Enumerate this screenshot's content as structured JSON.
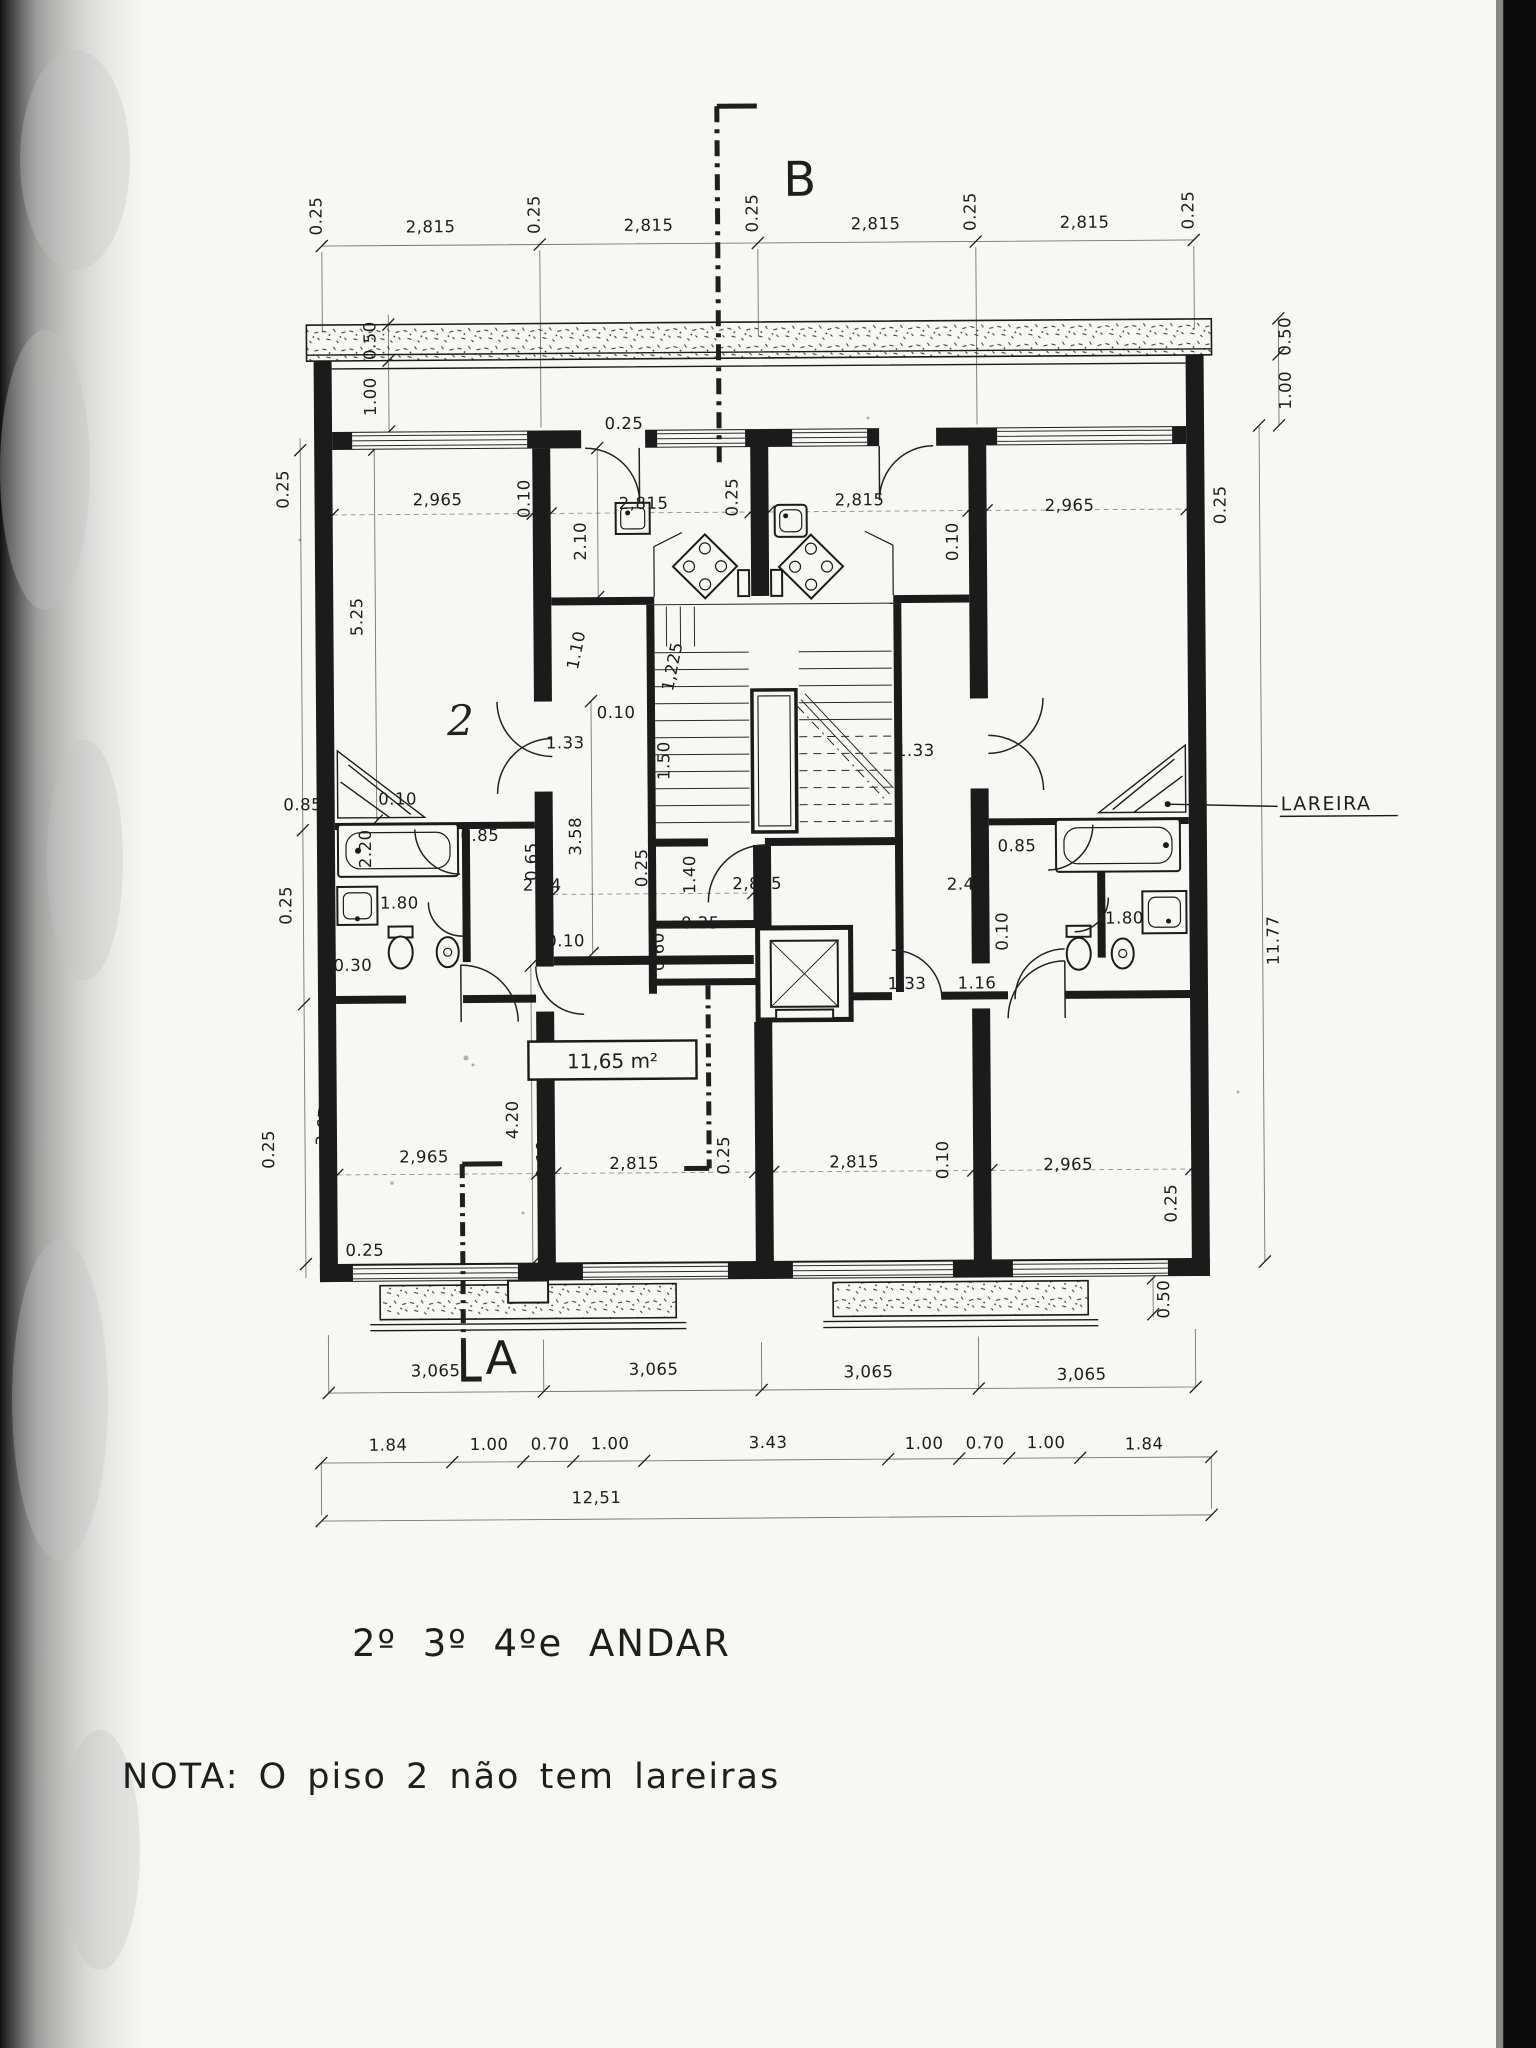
{
  "title": {
    "floor_label": "2º 3º 4ºe ANDAR"
  },
  "note": {
    "text": "NOTA: O  piso 2  não  tem  lareiras"
  },
  "annotations": {
    "lareira": "LAREIRA",
    "area_label": "11,65 m²",
    "section_b": "B",
    "section_a": "A",
    "hand_mark": "2"
  },
  "colors": {
    "ink": "#1b1b1b",
    "paper": "#f7f7f4",
    "scan_edge": "#0b0b0b"
  },
  "dimensions": [
    {
      "t": "0.25",
      "x": 326,
      "y": 213,
      "r": -90
    },
    {
      "t": "2,815",
      "x": 435,
      "y": 230
    },
    {
      "t": "0.25",
      "x": 544,
      "y": 213,
      "r": -90
    },
    {
      "t": "2,815",
      "x": 653,
      "y": 230
    },
    {
      "t": "0.25",
      "x": 762,
      "y": 213,
      "r": -90
    },
    {
      "t": "2,815",
      "x": 880,
      "y": 230
    },
    {
      "t": "0.25",
      "x": 980,
      "y": 213,
      "r": -90
    },
    {
      "t": "2,815",
      "x": 1089,
      "y": 230
    },
    {
      "t": "0.25",
      "x": 1198,
      "y": 213,
      "r": -90
    },
    {
      "t": "0.25",
      "x": 291,
      "y": 486,
      "r": -90
    },
    {
      "t": "0.50",
      "x": 379,
      "y": 338,
      "r": -90
    },
    {
      "t": "1.00",
      "x": 379,
      "y": 394,
      "r": -90
    },
    {
      "t": "5.25",
      "x": 364,
      "y": 614,
      "r": -90
    },
    {
      "t": "0.10",
      "x": 398,
      "y": 802
    },
    {
      "t": "2.20",
      "x": 371,
      "y": 846,
      "r": -90
    },
    {
      "t": "0.85",
      "x": 303,
      "y": 807
    },
    {
      "t": "1.80",
      "x": 399,
      "y": 906
    },
    {
      "t": "0.30",
      "x": 352,
      "y": 968
    },
    {
      "t": "0.25",
      "x": 291,
      "y": 902,
      "r": -90
    },
    {
      "t": "0.25",
      "x": 272,
      "y": 1146,
      "r": -90
    },
    {
      "t": "3.67",
      "x": 327,
      "y": 1124,
      "r": -85
    },
    {
      "t": "0.25",
      "x": 362,
      "y": 1253
    },
    {
      "t": "2,965",
      "x": 440,
      "y": 503
    },
    {
      "t": "2,815",
      "x": 646,
      "y": 508
    },
    {
      "t": "2,815",
      "x": 862,
      "y": 506
    },
    {
      "t": "2,965",
      "x": 1072,
      "y": 513
    },
    {
      "t": "0.10",
      "x": 532,
      "y": 497,
      "r": -90
    },
    {
      "t": "0.10",
      "x": 960,
      "y": 543,
      "r": -90
    },
    {
      "t": "2.10",
      "x": 588,
      "y": 540,
      "r": -90
    },
    {
      "t": "0.25",
      "x": 627,
      "y": 428
    },
    {
      "t": "0.25",
      "x": 740,
      "y": 497,
      "r": -90
    },
    {
      "t": "1.10",
      "x": 583,
      "y": 650,
      "r": -78
    },
    {
      "t": "1,225",
      "x": 679,
      "y": 667,
      "r": -78
    },
    {
      "t": "0.10",
      "x": 617,
      "y": 717
    },
    {
      "t": "1.33",
      "x": 566,
      "y": 747
    },
    {
      "t": "1.50",
      "x": 670,
      "y": 760,
      "r": -90
    },
    {
      "t": "1.33",
      "x": 916,
      "y": 757
    },
    {
      "t": "3.58",
      "x": 581,
      "y": 835,
      "r": -90
    },
    {
      "t": "0.65",
      "x": 537,
      "y": 860,
      "r": -90
    },
    {
      "t": "0.85",
      "x": 480,
      "y": 839
    },
    {
      "t": "2.44",
      "x": 542,
      "y": 889
    },
    {
      "t": "0.25",
      "x": 647,
      "y": 867,
      "r": -90
    },
    {
      "t": "1.40",
      "x": 695,
      "y": 874,
      "r": -90
    },
    {
      "t": "2,815",
      "x": 757,
      "y": 889
    },
    {
      "t": "2.44",
      "x": 966,
      "y": 891
    },
    {
      "t": "0.85",
      "x": 1017,
      "y": 853
    },
    {
      "t": "0.10",
      "x": 1007,
      "y": 933,
      "r": -90
    },
    {
      "t": "1.80",
      "x": 1124,
      "y": 926
    },
    {
      "t": "0.10",
      "x": 565,
      "y": 945
    },
    {
      "t": "0.25",
      "x": 700,
      "y": 928
    },
    {
      "t": "0.60",
      "x": 663,
      "y": 951,
      "r": -90
    },
    {
      "t": "1.33",
      "x": 906,
      "y": 990
    },
    {
      "t": "1.16",
      "x": 976,
      "y": 990
    },
    {
      "t": "4.20",
      "x": 516,
      "y": 1118,
      "r": -90
    },
    {
      "t": "2,965",
      "x": 422,
      "y": 1160
    },
    {
      "t": "0.10",
      "x": 546,
      "y": 1158,
      "r": -90
    },
    {
      "t": "2,815",
      "x": 632,
      "y": 1168
    },
    {
      "t": "0.25",
      "x": 727,
      "y": 1155,
      "r": -90
    },
    {
      "t": "2,815",
      "x": 852,
      "y": 1168
    },
    {
      "t": "0.10",
      "x": 946,
      "y": 1161,
      "r": -90
    },
    {
      "t": "2,965",
      "x": 1066,
      "y": 1172
    },
    {
      "t": "0.25",
      "x": 1174,
      "y": 1206,
      "r": -90
    },
    {
      "t": "0.50",
      "x": 1294,
      "y": 340,
      "r": -90
    },
    {
      "t": "1.00",
      "x": 1294,
      "y": 394,
      "r": -90
    },
    {
      "t": "0.25",
      "x": 1228,
      "y": 508,
      "r": -90
    },
    {
      "t": "11.77",
      "x": 1278,
      "y": 944,
      "r": -90
    },
    {
      "t": "0.50",
      "x": 1166,
      "y": 1302,
      "r": -90
    },
    {
      "t": "3,065",
      "x": 432,
      "y": 1374
    },
    {
      "t": "3,065",
      "x": 650,
      "y": 1374
    },
    {
      "t": "3,065",
      "x": 865,
      "y": 1378
    },
    {
      "t": "3,065",
      "x": 1078,
      "y": 1382
    },
    {
      "t": "1.84",
      "x": 384,
      "y": 1448
    },
    {
      "t": "1.00",
      "x": 485,
      "y": 1448
    },
    {
      "t": "0.70",
      "x": 546,
      "y": 1448
    },
    {
      "t": "1.00",
      "x": 606,
      "y": 1448
    },
    {
      "t": "3.43",
      "x": 764,
      "y": 1448
    },
    {
      "t": "1.00",
      "x": 920,
      "y": 1450
    },
    {
      "t": "0.70",
      "x": 981,
      "y": 1450
    },
    {
      "t": "1.00",
      "x": 1042,
      "y": 1450
    },
    {
      "t": "1.84",
      "x": 1140,
      "y": 1452
    },
    {
      "t": "12,51",
      "x": 592,
      "y": 1502
    }
  ]
}
